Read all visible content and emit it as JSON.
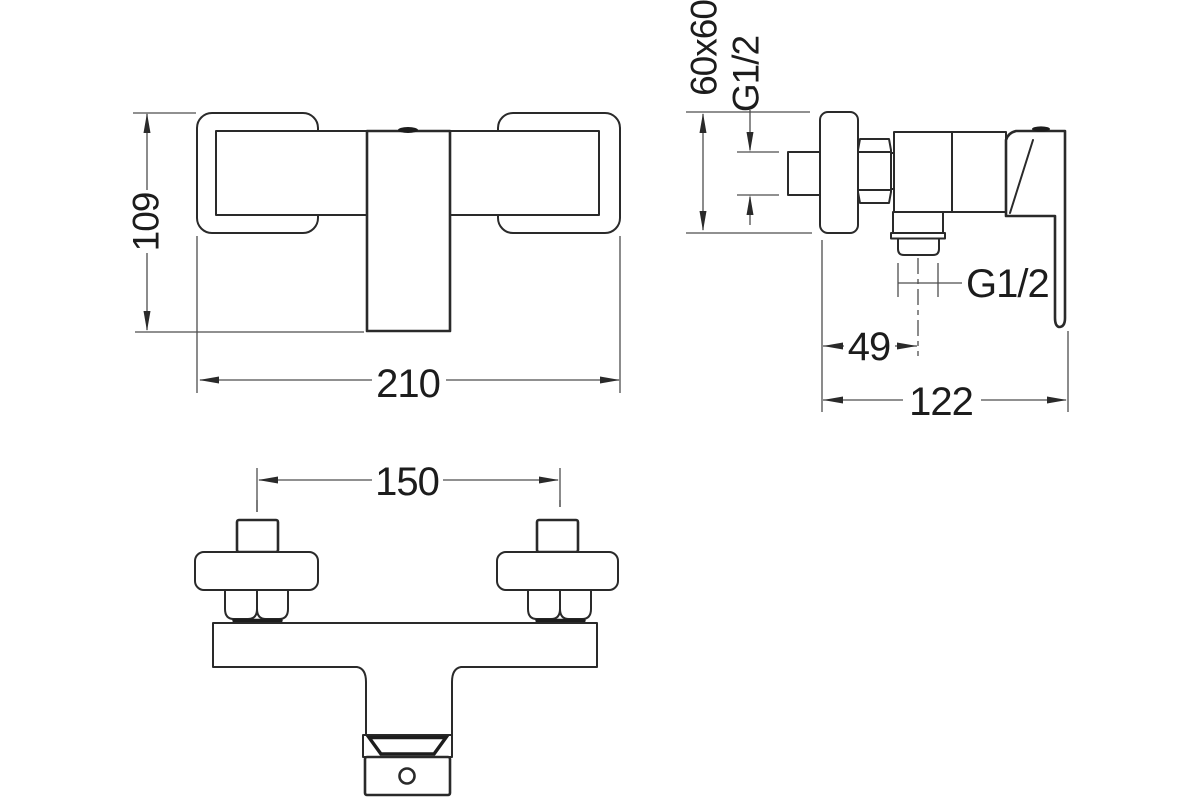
{
  "drawing": {
    "kind": "technical-dimension-drawing",
    "colors": {
      "background": "#ffffff",
      "part_line": "#2a2a2a",
      "dimension_line": "#4d4d4d",
      "text": "#1c1c1c"
    },
    "views": {
      "front": {
        "height": "109",
        "width": "210"
      },
      "side": {
        "flange_size": "60x60",
        "inlet_thread": "G1/2",
        "outlet_thread": "G1/2",
        "outlet_offset": "49",
        "depth": "122"
      },
      "top": {
        "center_distance": "150"
      }
    }
  }
}
